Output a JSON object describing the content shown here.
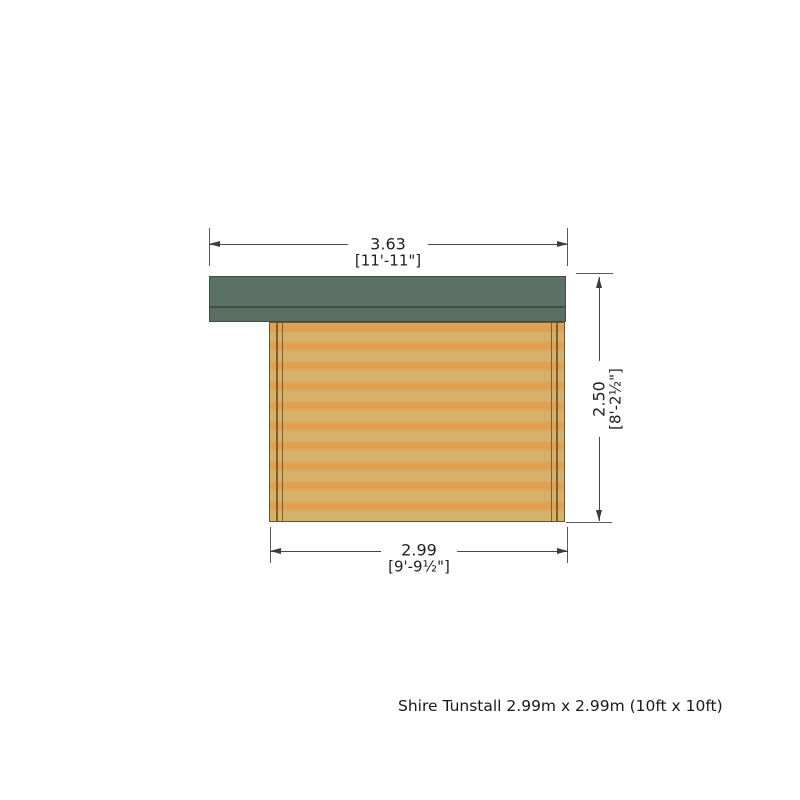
{
  "caption": "Shire Tunstall 2.99m x 2.99m (10ft x 10ft)",
  "dimensions": {
    "top": {
      "metric": "3.63",
      "imperial": "[11'-11\"]"
    },
    "right": {
      "metric": "2.50",
      "imperial": "[8'-2½\"]"
    },
    "bottom": {
      "metric": "2.99",
      "imperial": "[9'-9½\"]"
    }
  },
  "colors": {
    "roof": "#5d7266",
    "roof_edge": "#3f4f45",
    "wood_light": "#d5b26b",
    "wood_stripe": "#e0a04f",
    "wood_trim": "#7f6029",
    "dimension_line": "#474747",
    "text": "#1f1f1f",
    "background": "#ffffff"
  }
}
